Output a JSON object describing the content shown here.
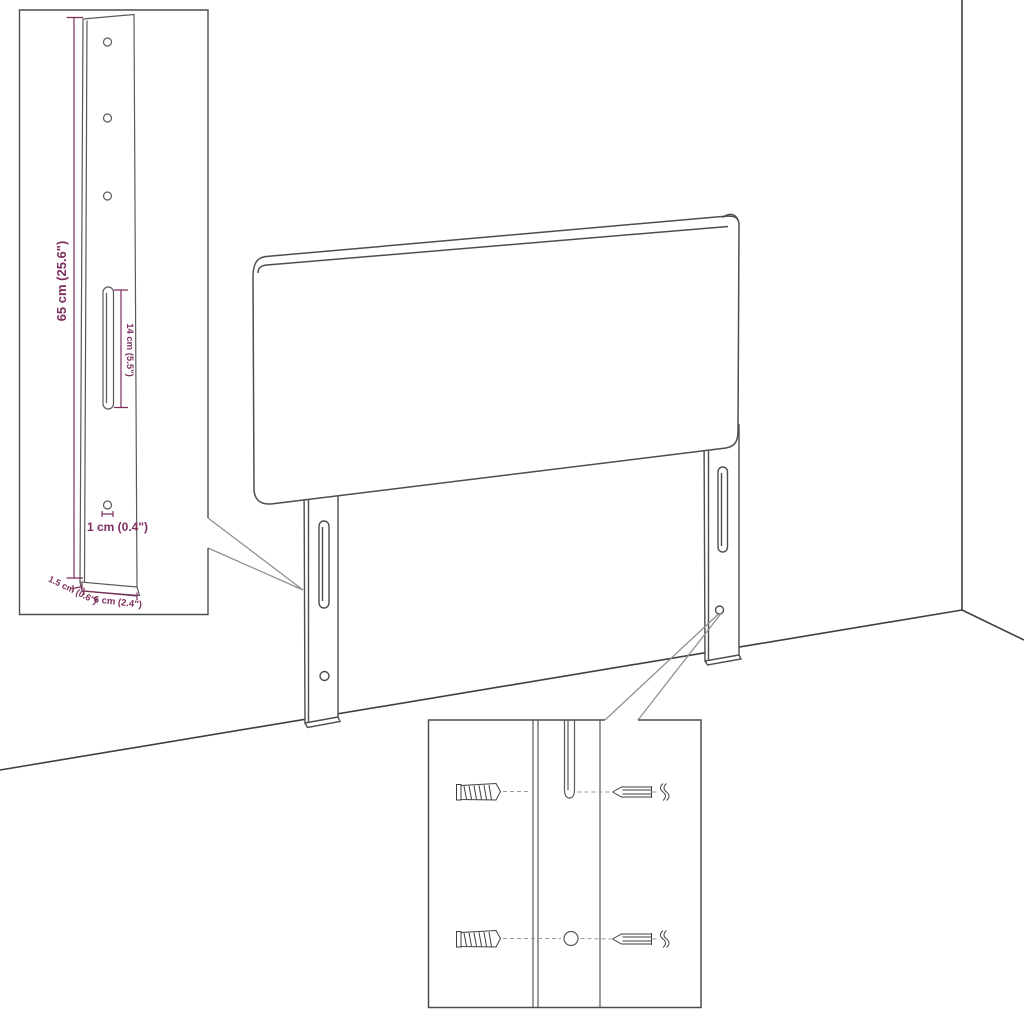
{
  "diagram": {
    "description": "Headboard with mounting legs - dimension and wall-mounting detail diagram",
    "bracket_inset": {
      "height_label": "65 cm (25.6\")",
      "slot_length_label": "14 cm (5.5\")",
      "hole_diameter_label": "1 cm (0.4\")",
      "depth_label": "1.5 cm (0.6\")",
      "width_label": "6 cm (2.4\")"
    },
    "colors": {
      "background": "#ffffff",
      "drawing_line": "#4d4d4d",
      "dimension_accent": "#7d2e5d",
      "callout_line": "#909090"
    }
  }
}
